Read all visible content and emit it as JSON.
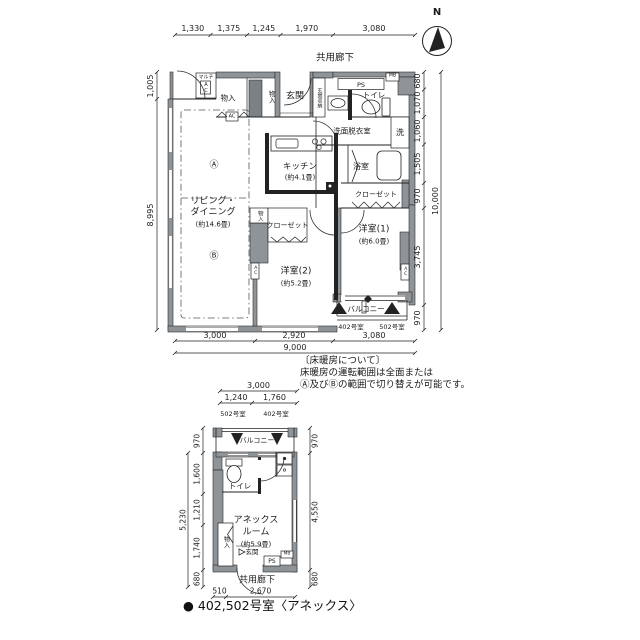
{
  "north": {
    "label": "N"
  },
  "main": {
    "corridor": "共用廊下",
    "rooms": {
      "multi_ac_1": "マルチ",
      "multi_ac_2": "AC",
      "storage1": "物入",
      "storage2": "物入",
      "storage3": "物入",
      "entrance": "玄関",
      "entrance_storage": "玄関収納",
      "ps": "PS",
      "mb": "MB",
      "toilet": "トイレ",
      "washroom": "洗面脱衣室",
      "laundry": "洗",
      "bath": "浴室",
      "closet1": "クローゼット",
      "closet2": "クローゼット",
      "kitchen": "キッチン",
      "kitchen_size": "(約4.1畳)",
      "zone_a": "Ⓐ",
      "zone_b": "Ⓑ",
      "living1": "リビング・",
      "living2": "ダイニング",
      "living_size": "(約14.6畳)",
      "bedroom1": "洋室(1)",
      "bedroom1_size": "(約6.0畳)",
      "bedroom2": "洋室(2)",
      "bedroom2_size": "(約5.2畳)",
      "ac1": "AC",
      "ac2": "AC",
      "ac3": "AC",
      "balcony": "バルコニー",
      "unit402": "402号室",
      "unit502": "502号室"
    },
    "dims": {
      "top": [
        "1,330",
        "1,375",
        "1,245",
        "1,970",
        "3,080"
      ],
      "left": [
        "1,005",
        "8,995"
      ],
      "right": [
        "680",
        "1,070",
        "1,060",
        "1,505",
        "970",
        "3,745",
        "970"
      ],
      "right_total": "10,000",
      "bottom": [
        "3,000",
        "2,920",
        "3,080"
      ],
      "bottom_total": "9,000"
    }
  },
  "note": {
    "line1": "〔床暖房について〕",
    "line2": "床暖房の運転範囲は全面または",
    "line3": "Ⓐ及びⒷの範囲で切り替えが可能です。"
  },
  "annex": {
    "corridor": "共用廊下",
    "rooms": {
      "balcony": "バルコニー",
      "toilet": "トイレ",
      "room1": "アネックス",
      "room2": "ルーム",
      "room_size": "(約5.9畳)",
      "storage": "物入",
      "entrance": "玄関",
      "ps": "PS",
      "mb": "MB",
      "unit502": "502号室",
      "unit402": "402号室"
    },
    "dims": {
      "top_total": "3,000",
      "top": [
        "1,240",
        "1,760"
      ],
      "left": [
        "970",
        "1,600",
        "1,210",
        "1,740",
        "680"
      ],
      "left_total": "5,230",
      "right": [
        "970",
        "4,550",
        "680"
      ],
      "bottom": [
        "510",
        "2,670"
      ]
    }
  },
  "caption": "● 402,502号室〈アネックス〉"
}
